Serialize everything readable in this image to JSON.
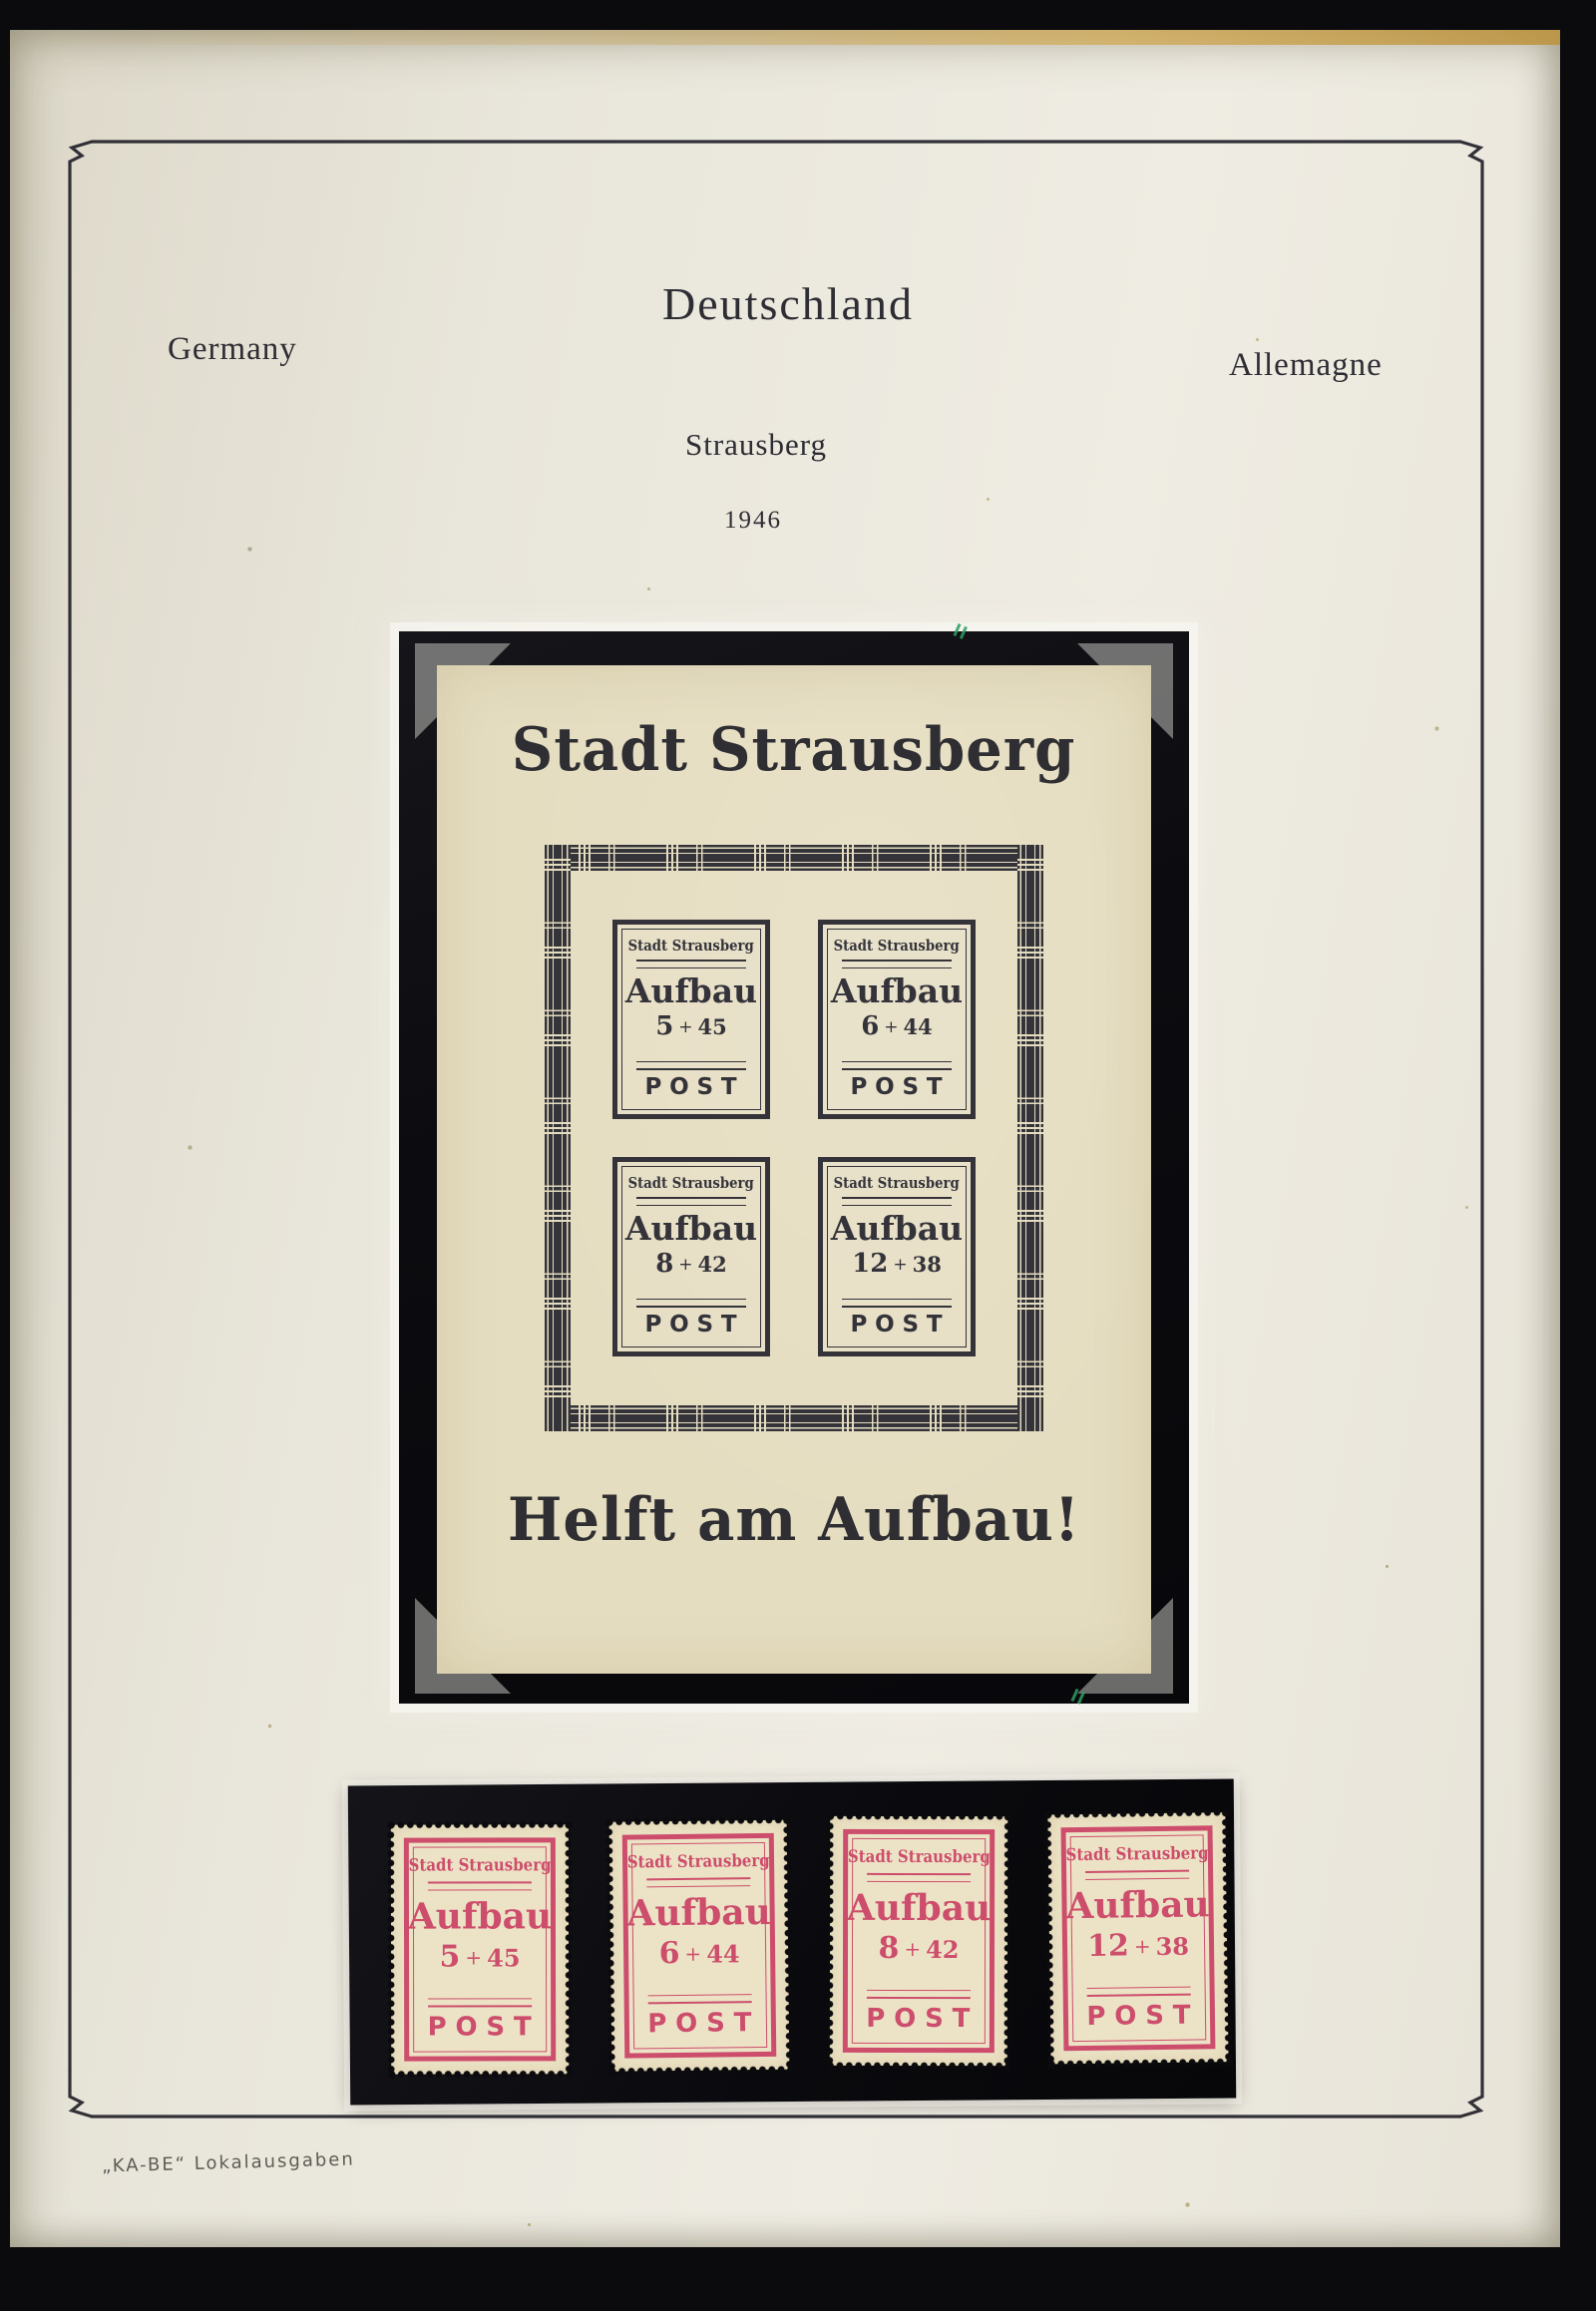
{
  "page": {
    "header": {
      "title": "Deutschland",
      "left_label": "Germany",
      "right_label": "Allemagne",
      "subtitle": "Strausberg",
      "year": "1946"
    },
    "footer_note": "„KA-BE“ Lokalausgaben"
  },
  "souvenir_sheet": {
    "title": "Stadt Strausberg",
    "slogan": "Helft am Aufbau!",
    "city_label": "Stadt Strausberg",
    "word_label": "Aufbau",
    "post_label": "POST",
    "plus_sign": "+",
    "stamps": [
      {
        "value": "5",
        "surcharge": "45"
      },
      {
        "value": "6",
        "surcharge": "44"
      },
      {
        "value": "8",
        "surcharge": "42"
      },
      {
        "value": "12",
        "surcharge": "38"
      }
    ]
  },
  "stamp_row": {
    "city_label": "Stadt Strausberg",
    "word_label": "Aufbau",
    "post_label": "POST",
    "plus_sign": "+",
    "stamps": [
      {
        "value": "5",
        "surcharge": "45"
      },
      {
        "value": "6",
        "surcharge": "44"
      },
      {
        "value": "8",
        "surcharge": "42"
      },
      {
        "value": "12",
        "surcharge": "38"
      }
    ]
  },
  "colors": {
    "background": "#0b0b0d",
    "album_page": "#e9e6db",
    "sheet_paper": "#e5ddc0",
    "stamp_paper": "#ece3c6",
    "block_ink": "#34333a",
    "stamp_red": "#cd4e6c",
    "mount_black": "#0c0c10",
    "pencil_mark_green": "#2f9e62"
  }
}
